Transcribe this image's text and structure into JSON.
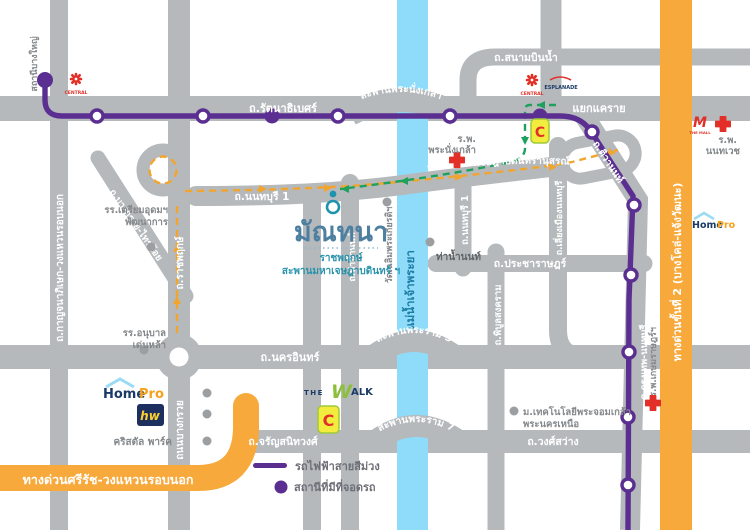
{
  "colors": {
    "road": "#b5b9bc",
    "river": "#8edcf9",
    "expressway": "#f8a93c",
    "mrt_purple": "#5b2e91",
    "route_orange": "#f2a52e",
    "route_green": "#1fa05c",
    "title_blue": "#4d7fa1",
    "teal": "#1f93ad"
  },
  "project": {
    "name": "มัณทนา",
    "sub1": "ราชพฤกษ์",
    "sub2": "สะพานมหาเจษฎาบดินทร์ ฯ"
  },
  "roads": {
    "rattanathibet": "ถ.รัตนาธิเบศร์",
    "khae_rai": "แยกแคราย",
    "sanambinnam": "ถ.สนามบินน้ำ",
    "nonthaburi1": "ถ.นนทบุรี 1",
    "ratchaphruek": "ถ.ราชพฤกษ์",
    "bang_kruai": "ถนนบางกรวย",
    "bang_kruai_sai_noi": "ถ.บางกรวย-ไทรน้อย",
    "kanchanaphisek": "ถ.กาญจนาภิเษก-วงแหวนรอบนอก",
    "nakhon_in": "ถ.นครอินทร์",
    "charansanitwong": "ถ.จรัญสนิทวงศ์",
    "wong_sawang": "ถ.วงศ์สว่าง",
    "pracharat": "ถ.ประชาราษฎร์",
    "phibunsongkhram": "ถ.พิบูลสงคราม",
    "liang_mueang": "ถ.เลี่ยงเมืองนนทบุรี",
    "tiwanon": "ถ.ติวานนท์",
    "krungthep_nonthaburi": "ถ.กรุงเทพ-นนทบุรี",
    "tha_nam_non": "ถ.ท่าน้ำนนท์"
  },
  "bridges": {
    "phranangklao": "สะพานพระนั่งเกล้า",
    "maha_chesadabodin": "สะพานมหาเจษฎาบดินทรานุสรณ์",
    "rama5": "สะพานพระราม 5",
    "rama7": "สะพานพระราม 7"
  },
  "expressways": {
    "stage2": "ทางด่วนขั้นที่ 2 (บางโคล่-แจ้งวัฒนะ)",
    "sirat": "ทางด่วนศรีรัช-วงแหวนรอบนอก"
  },
  "river": {
    "name": "แม่น้ำเจ้าพระยา"
  },
  "stations": {
    "bang_yai": "สถานีบางใหญ่"
  },
  "legend": {
    "line_label": "รถไฟฟ้าสายสีม่วง",
    "parking_label": "สถานีที่มีที่จอดรถ"
  },
  "pois": {
    "central": "CENTRAL",
    "esplanade": "ESPLANADE",
    "the_mall": "THE MALL",
    "bigc": "C",
    "hosp_phranangklao": {
      "l1": "ร.พ.",
      "l2": "พระนั่งเกล้า"
    },
    "hosp_nonthavej": {
      "l1": "ร.พ.",
      "l2": "นนทเวช"
    },
    "hosp_kasemrat": "ร.พ.เกษมราษฎร์ฯ",
    "homepro": {
      "home": "Home",
      "pro": "Pro"
    },
    "hw": "hw",
    "the_walk": {
      "t": "THE",
      "w": "W",
      "alk": "ALK"
    },
    "crystal_park": "คริสตัล พาร์ค",
    "school_triam": {
      "l1": "รร.เตรียมอุดมฯ",
      "l2": "พัฒนาการ"
    },
    "school_anuban": {
      "l1": "รร.อนุบาล",
      "l2": "เด่นหล้า"
    },
    "tha_nam_non_pier": "ท่าน้ำนนท์",
    "wat_chalerm": "วัดเฉลิมพระเกียรติฯ",
    "kmutnb": {
      "l1": "ม.เทคโนโลยีพระจอมเกล้า",
      "l2": "พระนครเหนือ"
    }
  }
}
